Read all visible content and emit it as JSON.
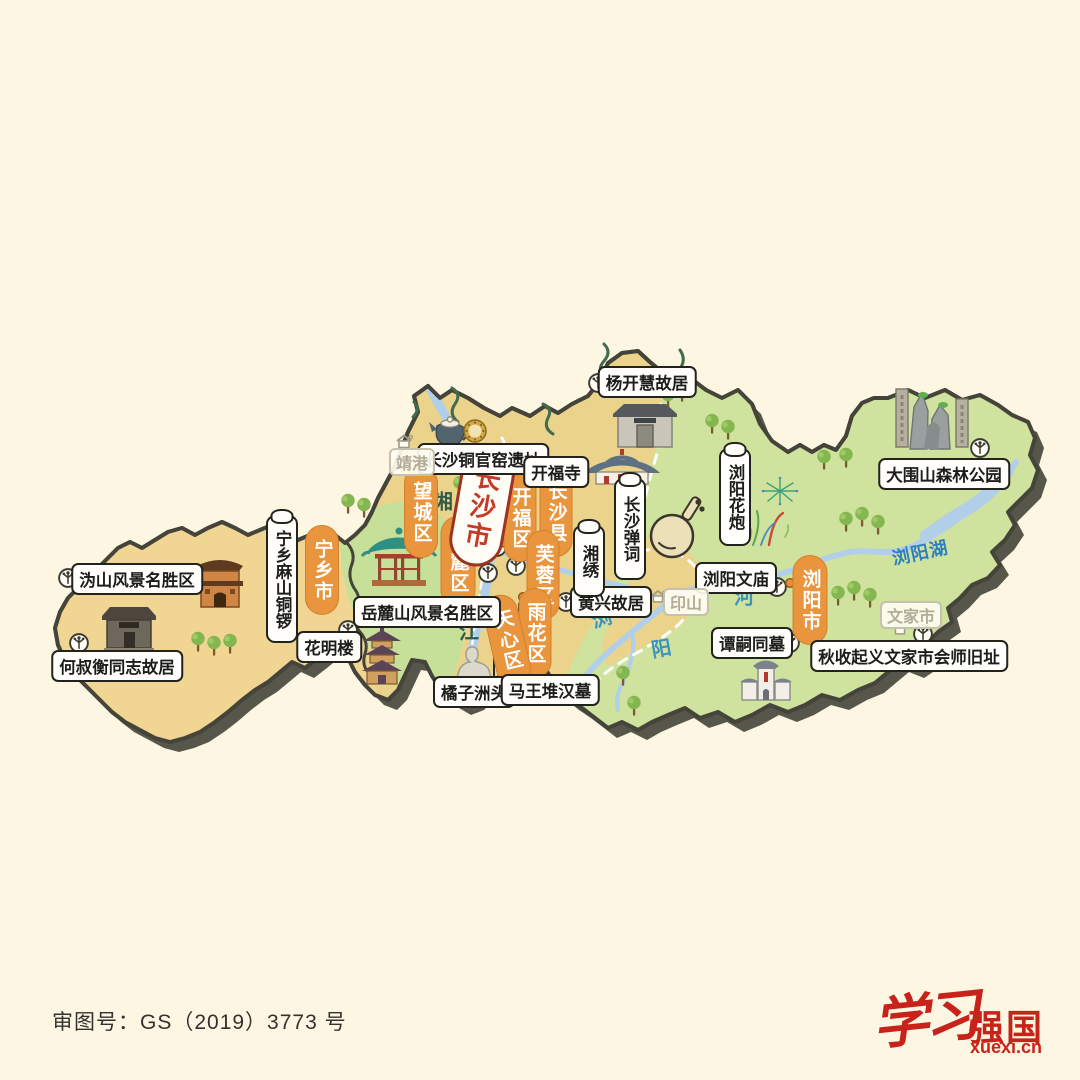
{
  "footer": {
    "license_label": "审图号：GS（2019）3773 号"
  },
  "logo": {
    "script_text": "学习",
    "bold_text": "强国",
    "domain": "xuexi.cn",
    "color": "#c8231a"
  },
  "palette": {
    "background": "#fdf6e2",
    "region_tan": "#f0d593",
    "region_yellow": "#ebd38c",
    "region_green": "#cfe29e",
    "district_orange": "#e9953e",
    "city_red": "#c23a28",
    "river_blue": "#b1cfe9",
    "outline_dark": "#45443a"
  },
  "map": {
    "city": {
      "name": "长沙市"
    },
    "districts": [
      {
        "name": "宁乡市"
      },
      {
        "name": "望城区"
      },
      {
        "name": "开福区"
      },
      {
        "name": "长沙县"
      },
      {
        "name": "岳麓区"
      },
      {
        "name": "芙蓉区"
      },
      {
        "name": "雨花区"
      },
      {
        "name": "天心区"
      },
      {
        "name": "浏阳市"
      }
    ],
    "attractions": [
      {
        "name": "长沙铜官窑遗址"
      },
      {
        "name": "开福寺"
      },
      {
        "name": "杨开慧故居"
      },
      {
        "name": "黄兴故居"
      },
      {
        "name": "岳麓山风景名胜区"
      },
      {
        "name": "沩山风景名胜区"
      },
      {
        "name": "何叔衡同志故居"
      },
      {
        "name": "花明楼"
      },
      {
        "name": "橘子洲头"
      },
      {
        "name": "马王堆汉墓"
      },
      {
        "name": "浏阳文庙"
      },
      {
        "name": "谭嗣同墓"
      },
      {
        "name": "秋收起义文家市会师旧址"
      },
      {
        "name": "大围山森林公园"
      }
    ],
    "specialties": [
      {
        "name": "宁乡麻山铜锣"
      },
      {
        "name": "长沙弹词"
      },
      {
        "name": "湘绣"
      },
      {
        "name": "浏阳花炮"
      }
    ],
    "towns": [
      {
        "name": "靖港"
      },
      {
        "name": "印山"
      },
      {
        "name": "文家市"
      }
    ],
    "water_labels": {
      "xiang_char_1": "湘",
      "xiang_char_2": "江",
      "liu_char": "浏",
      "yang_char": "阳",
      "he_char": "河",
      "lake": "浏阳湖"
    }
  }
}
